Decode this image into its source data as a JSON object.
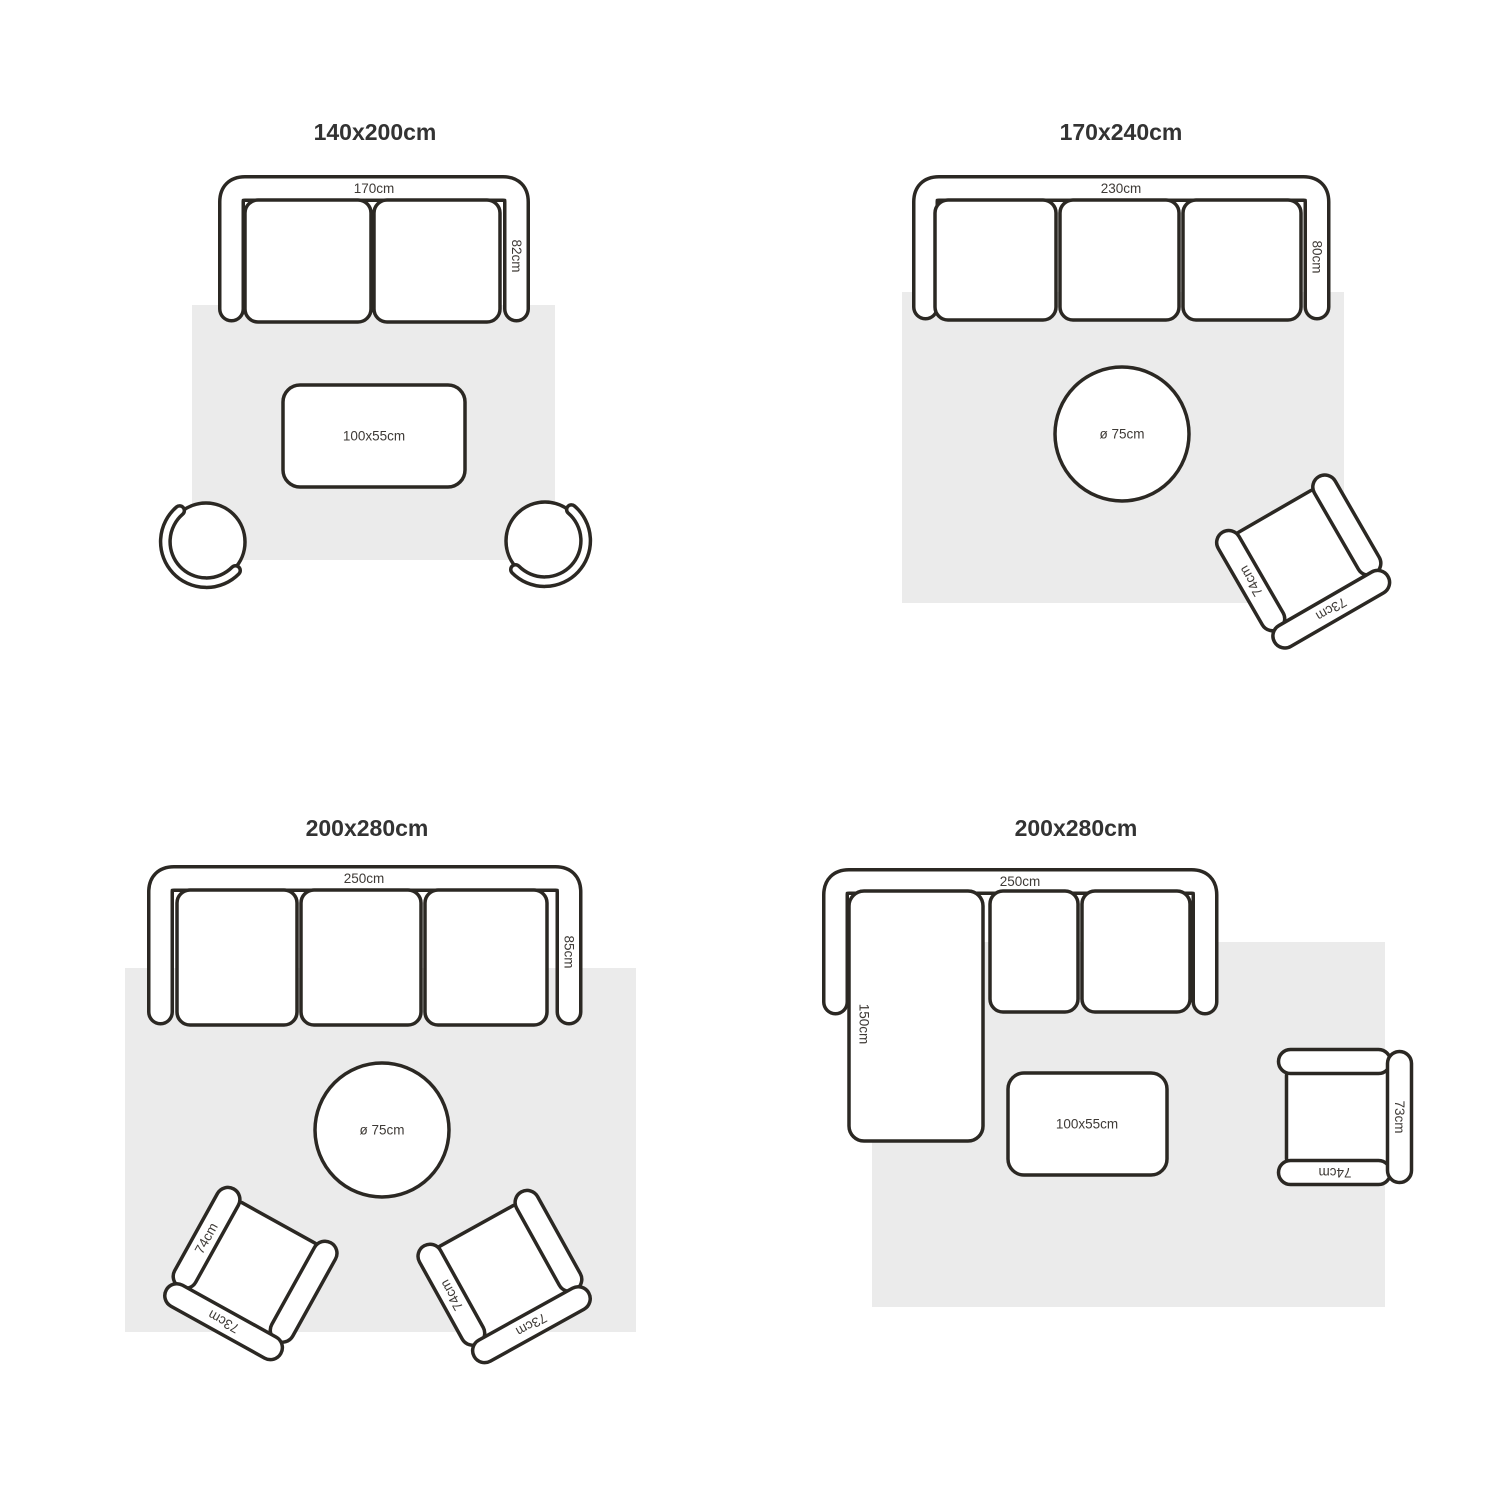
{
  "colors": {
    "background": "#ffffff",
    "outline": "#2b2823",
    "rug": "#ebebeb",
    "dimension_text": "#3e3a36",
    "title_text": "#333333"
  },
  "layouts": [
    {
      "title": "140x200cm",
      "sofa": {
        "width": "170cm",
        "depth": "82cm"
      },
      "coffee_table": {
        "size": "100x55cm"
      }
    },
    {
      "title": "170x240cm",
      "sofa": {
        "width": "230cm",
        "depth": "80cm"
      },
      "round_table": {
        "size": "ø 75cm"
      },
      "armchair": {
        "side": "74cm",
        "back": "73cm"
      }
    },
    {
      "title": "200x280cm",
      "sofa": {
        "width": "250cm",
        "depth": "85cm"
      },
      "round_table": {
        "size": "ø 75cm"
      },
      "armchair_left": {
        "side": "74cm",
        "back": "73cm"
      },
      "armchair_right": {
        "side": "74cm",
        "back": "73cm"
      }
    },
    {
      "title": "200x280cm",
      "sofa": {
        "width": "250cm",
        "chaise_depth": "150cm"
      },
      "coffee_table": {
        "size": "100x55cm"
      },
      "armchair": {
        "side": "74cm",
        "back": "73cm"
      }
    }
  ]
}
